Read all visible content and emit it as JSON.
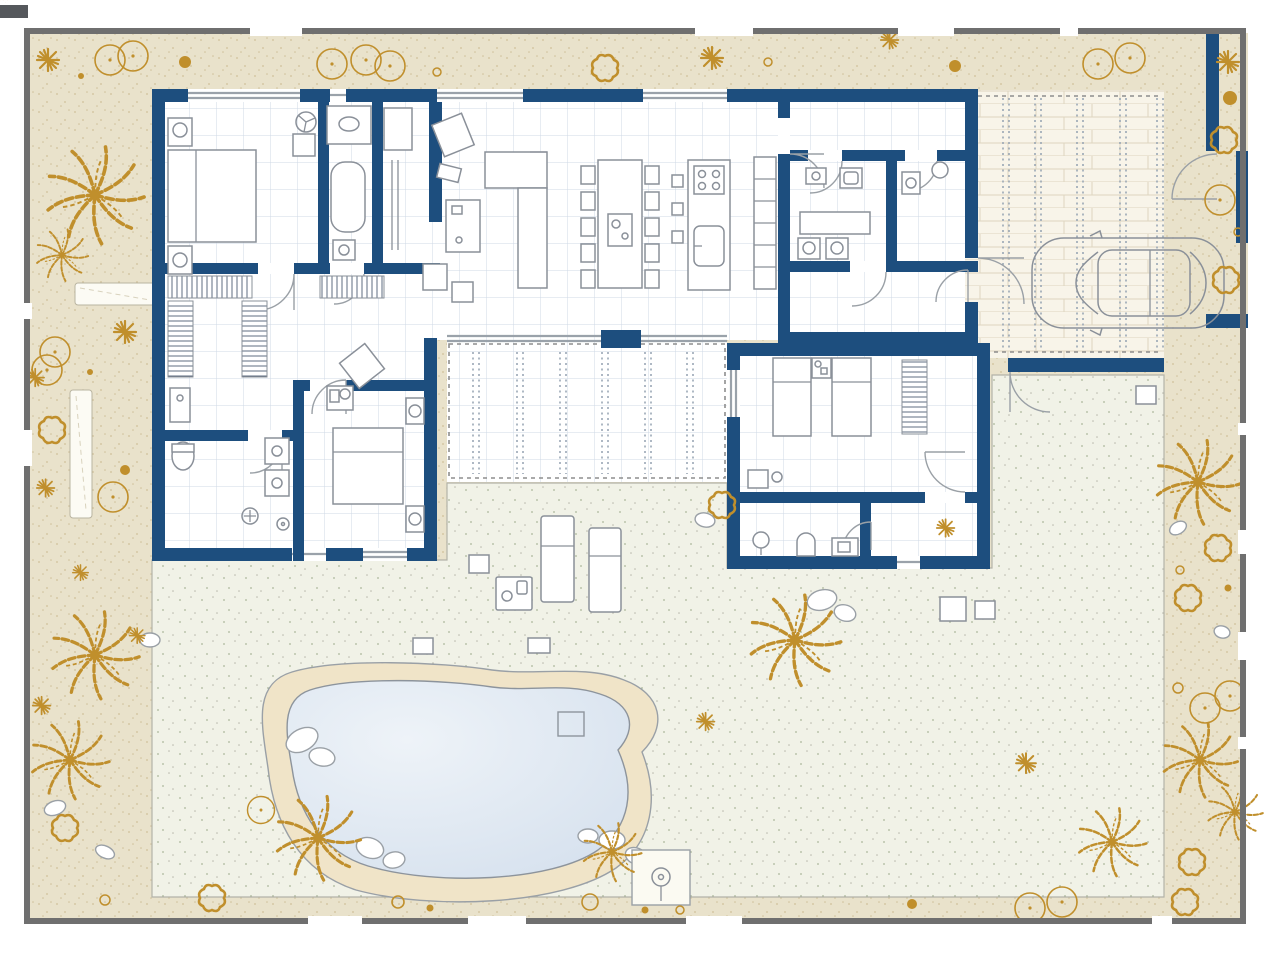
{
  "title": "villa-floor-plan",
  "colors": {
    "wall": "#1d4e7e",
    "fence": "#6f6f6f",
    "sand": "#e9e2cb",
    "sanddot": "#cfc09a",
    "gold": "#c08f2c",
    "garden": "#f1f2e7",
    "gardendot": "#aab69a",
    "tile": "#cfd9e6",
    "furn": "#8a9099",
    "waterl": "#eef3f8",
    "waterd": "#d6e1ee",
    "deck": "#f0e4c8",
    "brick": "#f8f4e9",
    "brickline": "#ded5bf",
    "glass": "#9aa2aa",
    "hatch": "#5f6d80"
  },
  "inventory": {
    "site_features": [
      "perimeter-fence",
      "sand-border-garden",
      "lawn-garden",
      "kidney-pool",
      "pool-deck",
      "covered-terrace-pergola",
      "brick-driveway",
      "parked-car",
      "outdoor-shower",
      "sun-loungers",
      "garden-side-table",
      "stepping-path",
      "planter-bed"
    ],
    "vegetation": [
      "palm-tree",
      "shrub-ring",
      "star-plant",
      "tree-canopy-circle",
      "rock"
    ],
    "rooms": [
      "bedroom",
      "ensuite-bathroom",
      "walk-in-closet",
      "dressing-room",
      "family-bathroom",
      "living-room",
      "dining-area",
      "kitchen",
      "laundry-room",
      "wc",
      "entry-hall",
      "guest-bedroom",
      "guest-bathroom",
      "corridor"
    ],
    "furniture": [
      "double-bed",
      "twin-bed",
      "nightstand",
      "wardrobe",
      "sofa-l-shaped",
      "armchair",
      "coffee-table",
      "dining-table-10-chairs",
      "kitchen-island",
      "cooktop",
      "kitchen-sink",
      "bathtub",
      "shower",
      "toilet",
      "washbasin",
      "washing-machine",
      "ceiling-fan",
      "desk",
      "sun-lounger"
    ],
    "counts": {
      "cars": 1,
      "sun_loungers": 2,
      "pools": 1,
      "dining_chairs": 10,
      "bar_stools": 3
    }
  }
}
